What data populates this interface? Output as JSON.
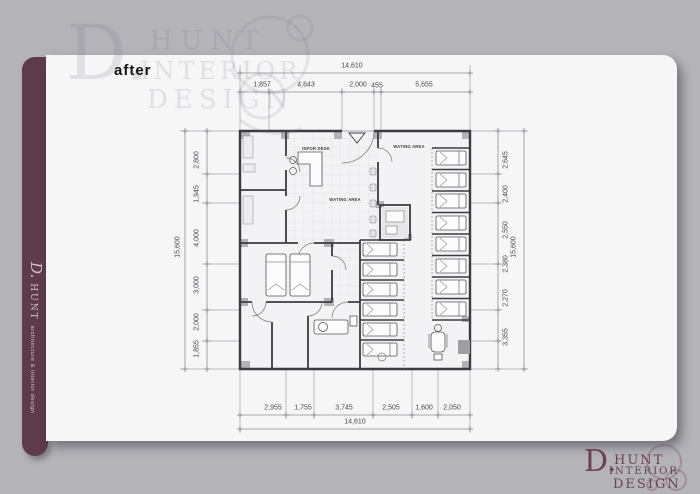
{
  "colors": {
    "background": "#b4b3b8",
    "card": "#f6f6f7",
    "sidebar_bar": "#5e3b49",
    "logo_maroon": "#6b4352",
    "plan_wall": "#3b3b41",
    "dimension_text": "#47474c"
  },
  "sidebar": {
    "brand_initial": "D.",
    "brand_name": "HUNT",
    "brand_tagline": "architecture & interior design"
  },
  "card": {
    "after_label": "after"
  },
  "watermark": {
    "initial": "D.",
    "word1": "HUNT",
    "word2": "INTERIOR",
    "word3": "DESIGN"
  },
  "logo": {
    "initial": "D.",
    "word1": "HUNT",
    "word2": "INTERIOR",
    "word3": "DESIGN"
  },
  "floor_plan": {
    "labels": {
      "info_desk": "INFOR DESK",
      "waiting_area_top": "WATING AREA",
      "waiting_area_center": "WATING AREA"
    },
    "dimensions": {
      "top": {
        "overall": "14,610",
        "segments": [
          "1,857",
          "4,643",
          "2,000",
          "455",
          "5,655"
        ]
      },
      "bottom": {
        "overall": "14,610",
        "segments": [
          "2,955",
          "1,755",
          "3,745",
          "2,505",
          "1,600",
          "2,050"
        ]
      },
      "left": {
        "overall": "15,600",
        "segments": [
          "2,800",
          "1,945",
          "4,000",
          "3,000",
          "2,000",
          "1,855"
        ]
      },
      "right": {
        "overall": "15,600",
        "segments": [
          "2,645",
          "2,400",
          "2,550",
          "2,380",
          "2,270",
          "3,355"
        ]
      }
    }
  }
}
